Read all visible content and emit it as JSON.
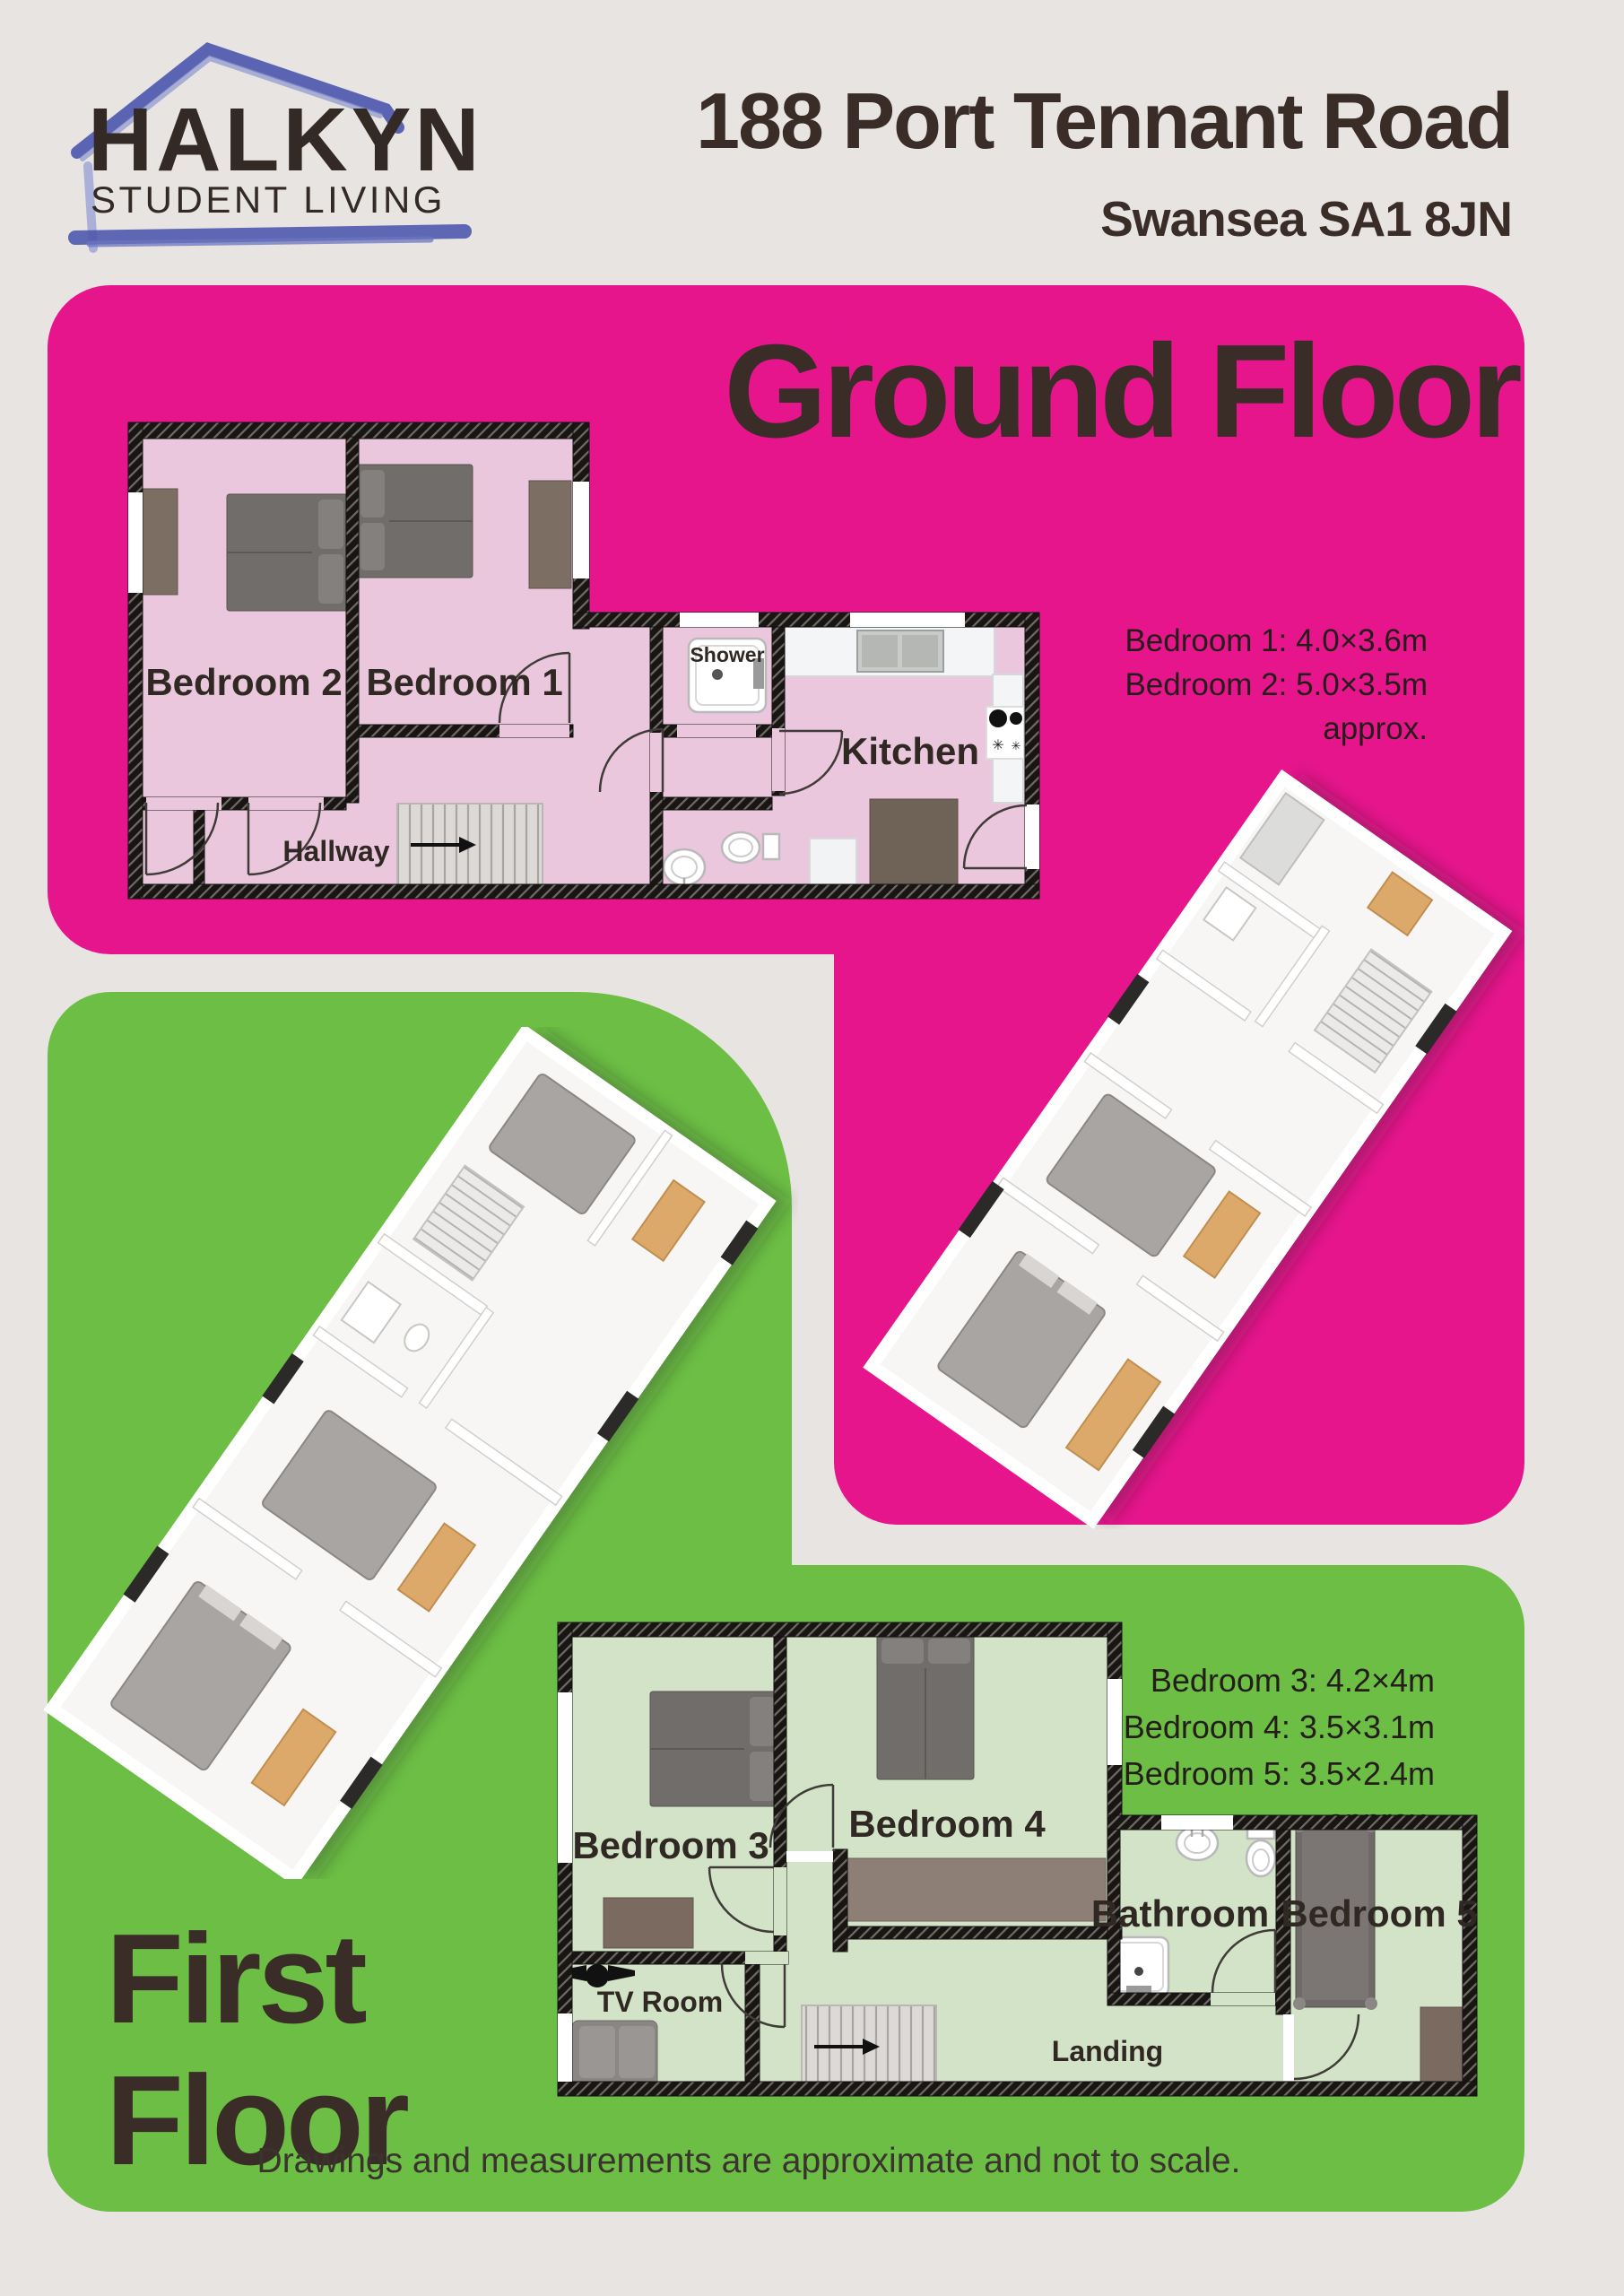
{
  "colors": {
    "page_bg": "#E8E4E2",
    "pink": "#E6158C",
    "green": "#6CBE45",
    "dark_text": "#3A2D28",
    "logo_blue": "#4E59AE",
    "floor_pink": "#EBC7DD",
    "floor_green": "#D3E3C7",
    "wall_dark": "#181512"
  },
  "header": {
    "logo_name": "HALKYN",
    "logo_tagline": "STUDENT LIVING",
    "title": "188 Port Tennant Road",
    "subtitle": "Swansea SA1 8JN"
  },
  "ground_floor": {
    "heading": "Ground Floor",
    "labels": {
      "bedroom2": "Bedroom 2",
      "bedroom1": "Bedroom 1",
      "shower": "Shower",
      "kitchen": "Kitchen",
      "hallway": "Hallway"
    },
    "measurements": [
      "Bedroom 1: 4.0×3.6m",
      "Bedroom 2: 5.0×3.5m",
      "approx."
    ]
  },
  "first_floor": {
    "heading_line1": "First",
    "heading_line2": "Floor",
    "labels": {
      "bedroom3": "Bedroom 3",
      "bedroom4": "Bedroom 4",
      "bedroom5": "Bedroom 5",
      "bathroom": "Bathroom",
      "tv_room": "TV Room",
      "landing": "Landing"
    },
    "measurements": [
      "Bedroom 3: 4.2×4m",
      "Bedroom 4: 3.5×3.1m",
      "Bedroom 5: 3.5×2.4m",
      "approx."
    ]
  },
  "footer": {
    "disclaimer": "Drawings and measurements are approximate and not to scale."
  }
}
